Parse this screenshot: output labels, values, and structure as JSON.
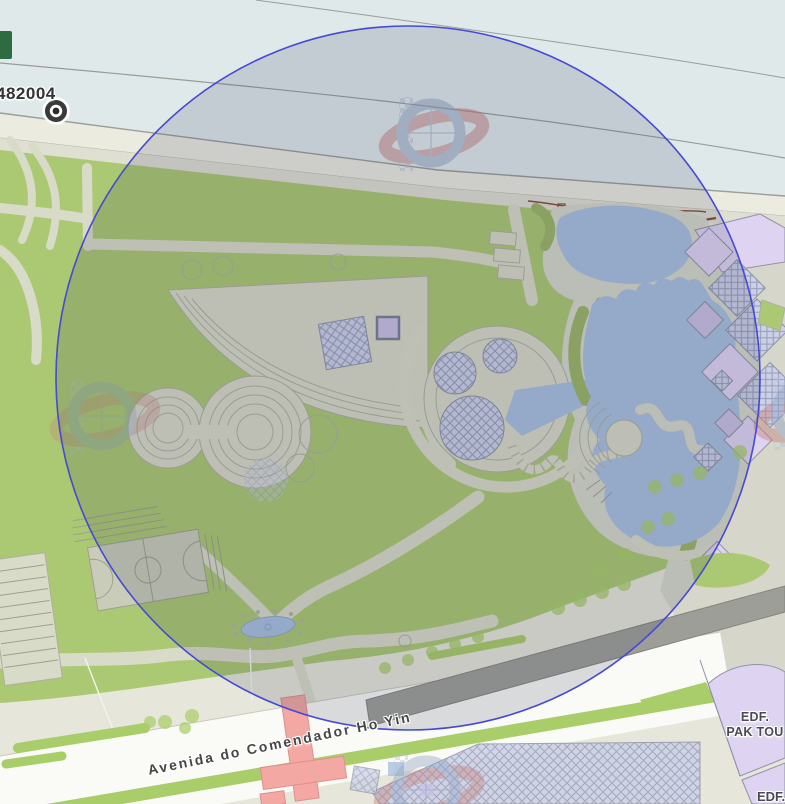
{
  "map": {
    "marker": {
      "id_label": "482004"
    },
    "street_label": "Avenida do Comendador Ho Yin",
    "buildings": {
      "pak_tou_line1": "EDF.",
      "pak_tou_line2": "PAK TOU",
      "edf_partial": "EDF."
    },
    "buffer_circle": {
      "cx": 408,
      "cy": 378,
      "r": 352
    }
  },
  "icons": {
    "marker": "target-ring-icon",
    "ghost": "compass-watermark-icon"
  },
  "colors": {
    "sea": "#dfe9ea",
    "cable": "#9c9c96",
    "promenade": "#ebebe0",
    "promenade2": "#dfdfd2",
    "grass": "#abc972",
    "grassDim": "#9db566",
    "pathFill": "#d9dbc9",
    "pathLine": "#adb09f",
    "plaza": "#d8dac8",
    "beige": "#e6e7da",
    "beigeDim": "#d6d7ca",
    "water": "#a9c0de",
    "road": "#fafaf6",
    "median": "#a9cd68",
    "purple": "#ded4f1",
    "purpleMid": "#cbc0e4",
    "hatchFill": "#ccd0e8",
    "hatchLine": "#9aa0ba",
    "edgeGray": "#8e93a6",
    "pink": "#f4a8a4",
    "pinkLine": "#df8e8b",
    "darkBand": "#9e9e98",
    "court": "#c9ccb8",
    "courtLine": "#9da08e",
    "circleStroke": "#4549d4",
    "circleFill": "rgba(44,50,84,0.155)",
    "ghostRed": "#c8817d",
    "ghostBlue": "#90a2c3",
    "checker": "#b9c0d4",
    "brown": "#8a4a38",
    "markerDark": "#3a3a3a",
    "textDark": "#3c3c3c",
    "labelGray": "#4a4a52",
    "darkGreen": "#2f6b41"
  }
}
